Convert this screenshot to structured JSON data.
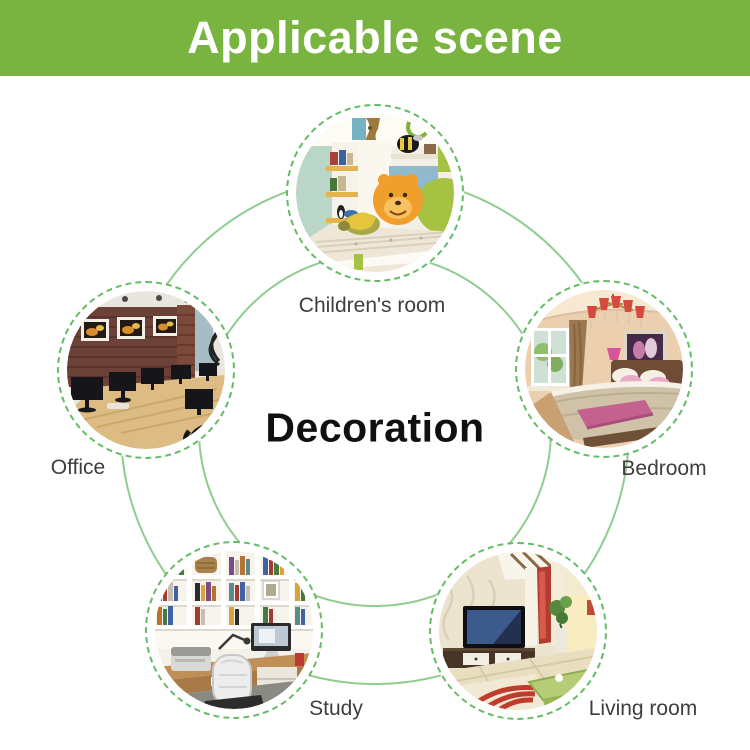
{
  "header": {
    "title": "Applicable scene"
  },
  "center": {
    "label": "Decoration"
  },
  "scenes": [
    {
      "id": "children-room",
      "label": "Children's room"
    },
    {
      "id": "bedroom",
      "label": "Bedroom"
    },
    {
      "id": "living-room",
      "label": "Living room"
    },
    {
      "id": "study",
      "label": "Study"
    },
    {
      "id": "office",
      "label": "Office"
    }
  ],
  "colors": {
    "banner_green": "#79b440",
    "ring_green": "#8fcd8f",
    "dash_green": "#66bb66",
    "title_text": "#ffffff",
    "label_text": "#3e3e3e",
    "center_text": "#101010"
  }
}
